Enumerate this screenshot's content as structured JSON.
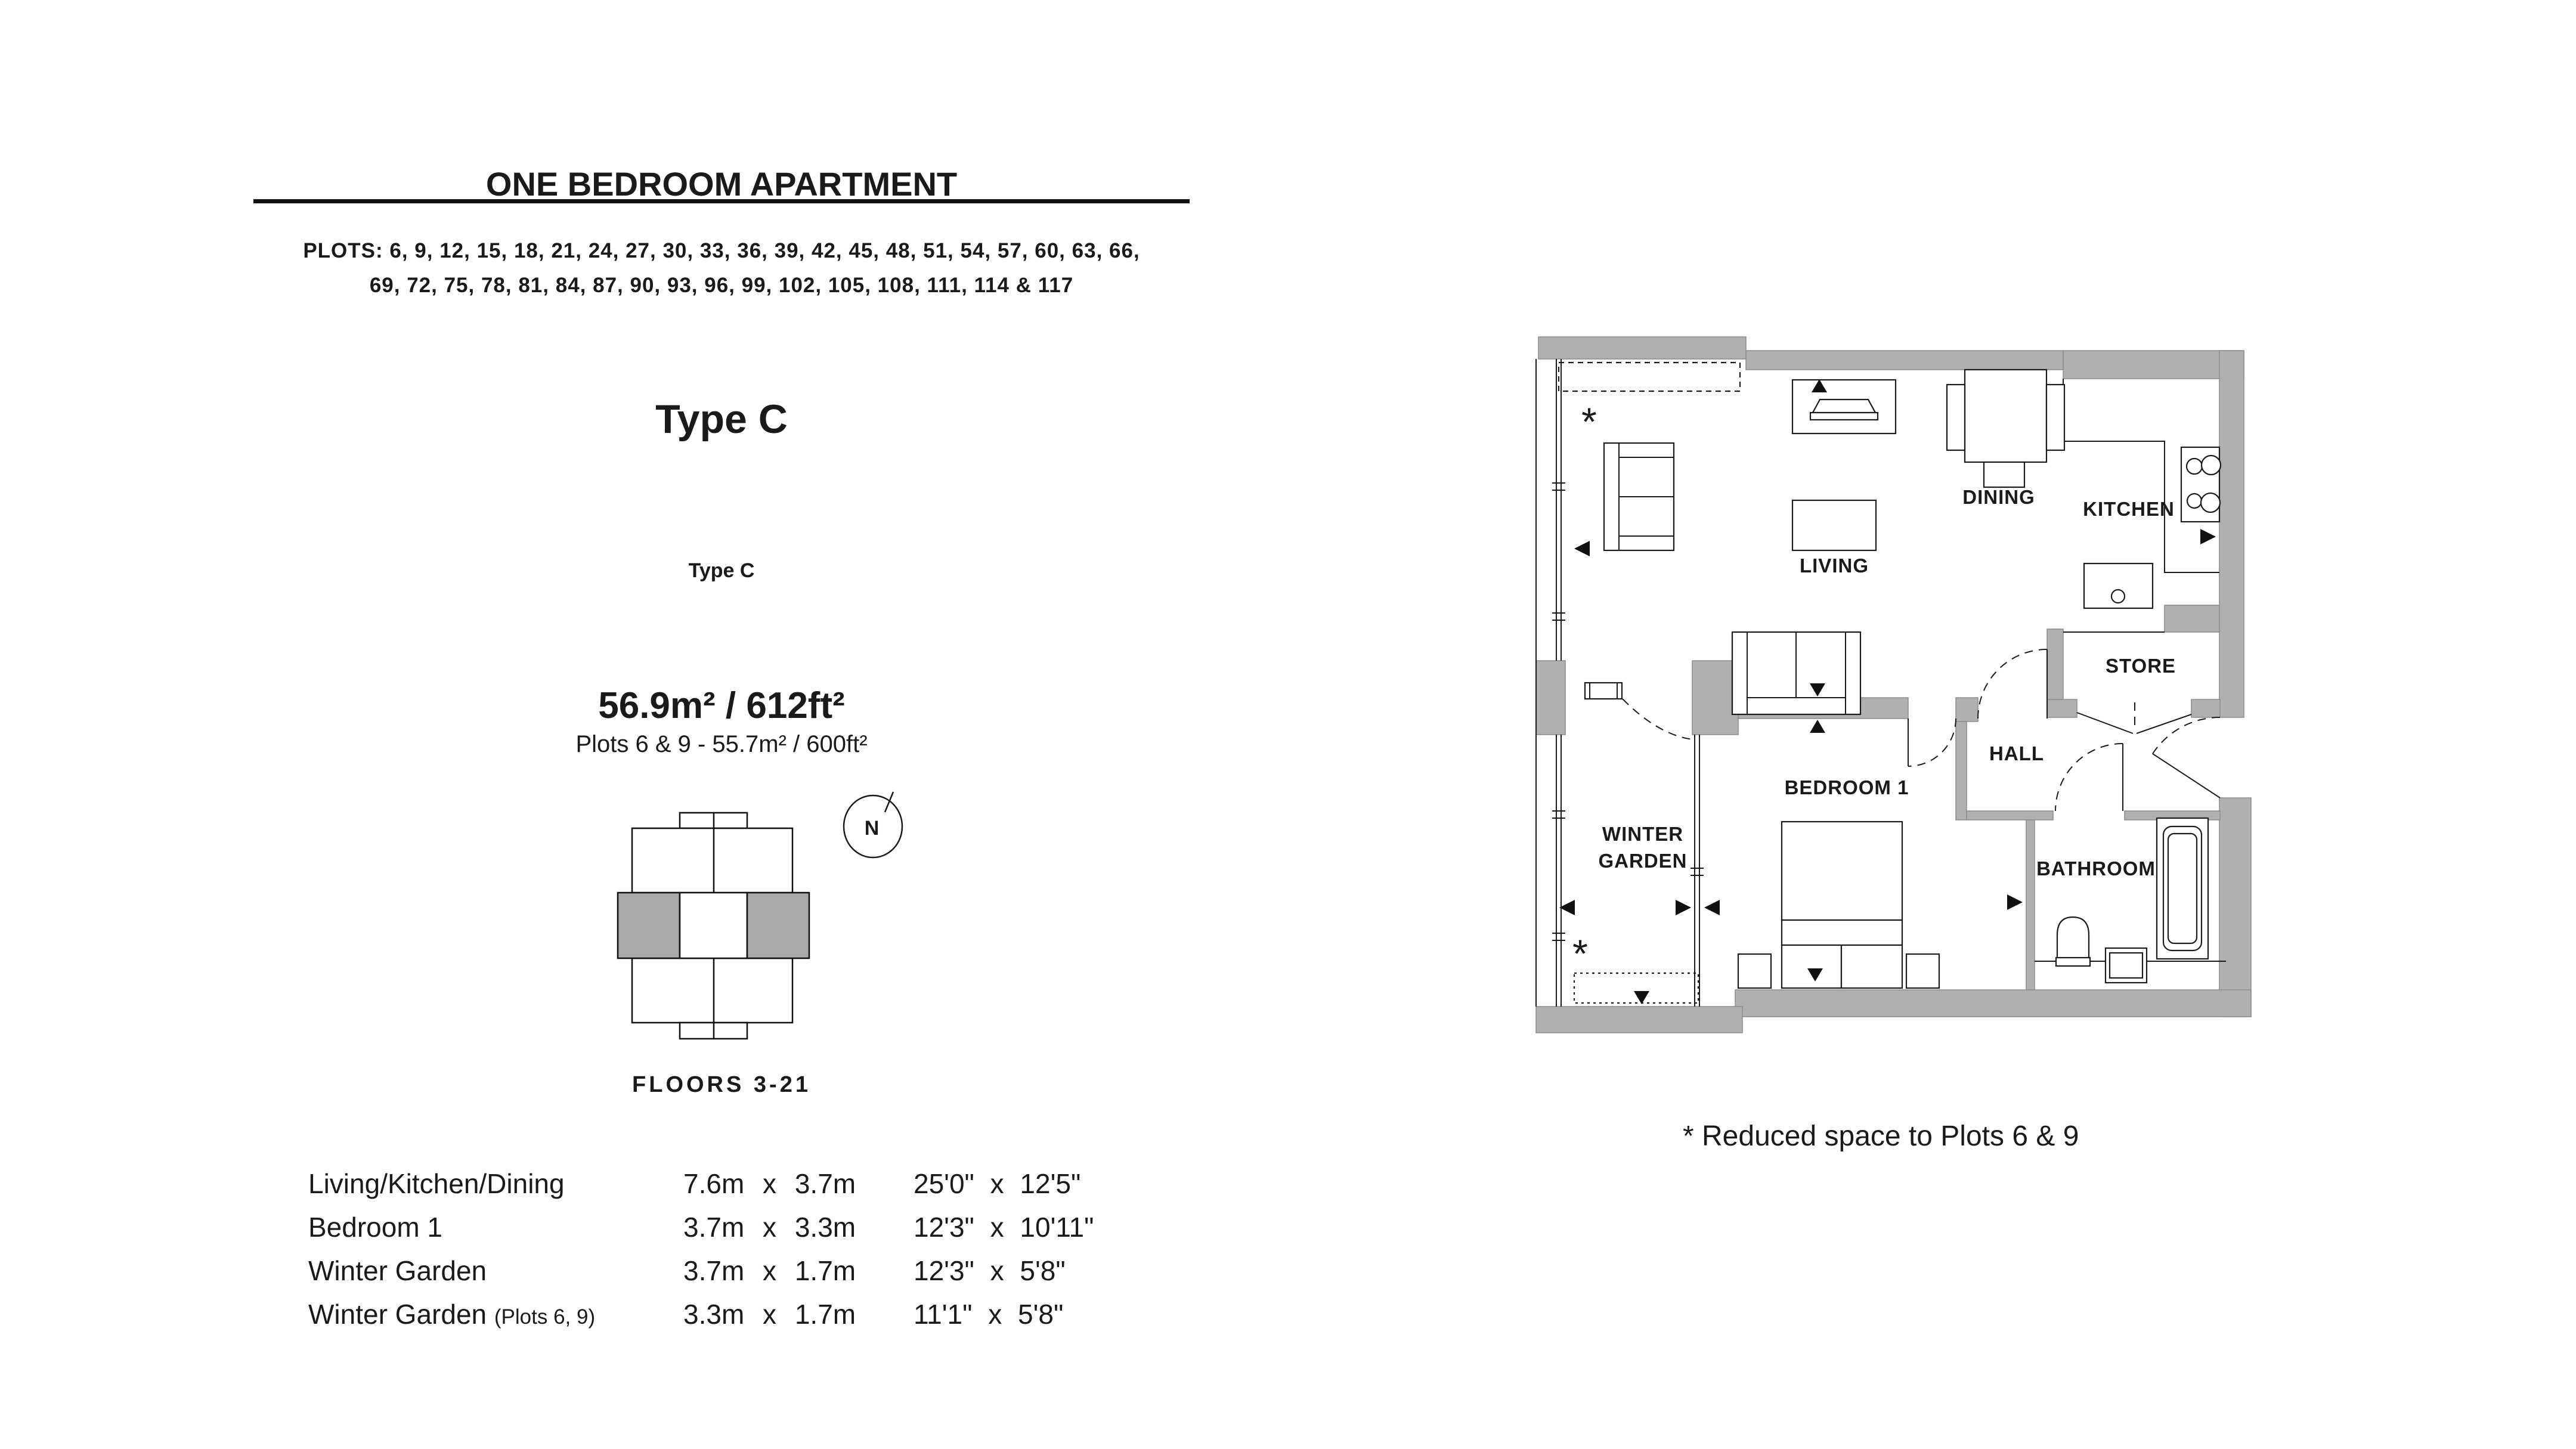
{
  "page": {
    "background": "#ffffff",
    "text_color": "#1a1a1a",
    "wall_color": "#b0b0b0",
    "key_plan_highlight_color": "#a9a9a9"
  },
  "header": {
    "title": "ONE BEDROOM APARTMENT",
    "plots_line1": "PLOTS: 6, 9, 12, 15, 18, 21, 24, 27, 30, 33, 36, 39, 42, 45, 48, 51, 54, 57, 60, 63, 66,",
    "plots_line2": "69, 72, 75, 78, 81, 84, 87, 90, 93, 96, 99, 102, 105, 108, 111, 114 & 117"
  },
  "unit": {
    "type_heading": "Type C",
    "key_plan_caption": "Type C",
    "area": "56.9m² / 612ft²",
    "area_note": "Plots 6 & 9 - 55.7m² / 600ft²",
    "floors_label": "FLOORS 3-21",
    "compass_label": "N"
  },
  "dimensions_table": {
    "rows": [
      {
        "room": "Living/Kitchen/Dining",
        "room_note": "",
        "metric": "7.6m x 3.7m",
        "imperial": "25'0\" x 12'5\""
      },
      {
        "room": "Bedroom 1",
        "room_note": "",
        "metric": "3.7m x 3.3m",
        "imperial": "12'3\" x 10'11\""
      },
      {
        "room": "Winter Garden",
        "room_note": "",
        "metric": "3.7m x 1.7m",
        "imperial": "12'3\" x 5'8\""
      },
      {
        "room": "Winter Garden",
        "room_note": "(Plots 6, 9)",
        "metric": "3.3m x 1.7m",
        "imperial": "11'1\" x 5'8\""
      }
    ]
  },
  "floor_plan": {
    "rooms": {
      "living": "LIVING",
      "dining": "DINING",
      "kitchen": "KITCHEN",
      "store": "STORE",
      "hall": "HALL",
      "bedroom": "BEDROOM 1",
      "winter_garden_line1": "WINTER",
      "winter_garden_line2": "GARDEN",
      "bathroom": "BATHROOM"
    },
    "reduced_space_marker": "*",
    "note": "* Reduced space to Plots 6 & 9"
  }
}
